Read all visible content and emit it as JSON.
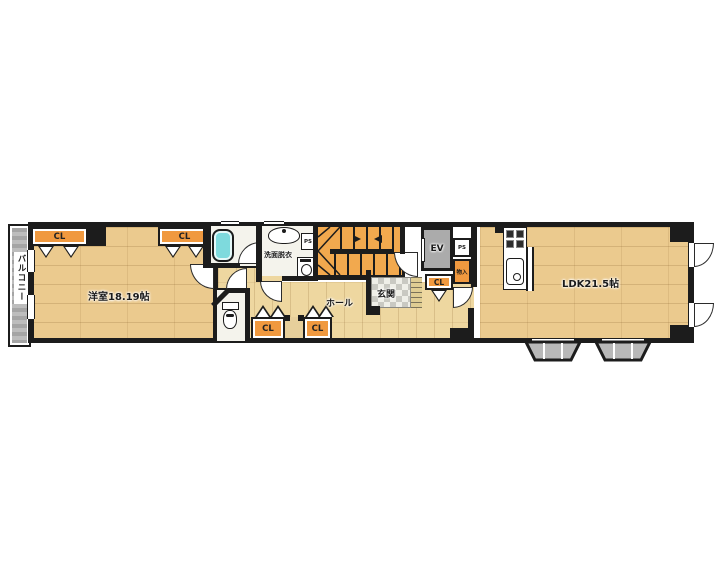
{
  "floorplan": {
    "type": "apartment-floor-plan",
    "labels": {
      "balcony": "バルコニー",
      "western_room": "洋室18.19帖",
      "ldk": "LDK21.5帖",
      "hall": "ホール",
      "entrance": "玄関",
      "washroom": "洗面脱衣",
      "elevator": "EV",
      "closet": "CL",
      "pipe_space": "PS",
      "storage": "物入"
    },
    "colors": {
      "wall": "#1c1c1c",
      "wood_floor": "#ebca8e",
      "hall_floor": "#eed7a0",
      "closet": "#f0993f",
      "stairs": "#f2a94e",
      "balcony": "#b3b3b3",
      "elevator": "#ababab",
      "bathtub": "#7edadd",
      "entrance_tile_dark": "#c9c9c2",
      "background": "#ffffff"
    }
  }
}
